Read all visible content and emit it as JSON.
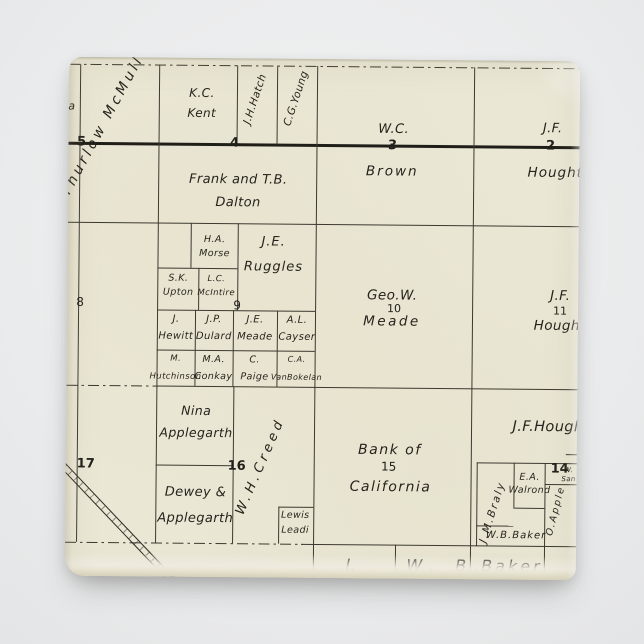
{
  "scene": {
    "type": "vintage plat map magnet product photo",
    "background_color": "#eaebec",
    "paper_color": "#eae7d5",
    "line_color": "#3c3930",
    "road_color": "#201e19",
    "text_color": "#26231c"
  },
  "map": {
    "section_numbers": {
      "s5": "5",
      "s4": "4",
      "s3": "3",
      "s2": "2",
      "s8": "8",
      "s9": "9",
      "s10": "10",
      "s11": "11",
      "s17": "17",
      "s16": "16",
      "s15": "15",
      "s14": "14"
    },
    "labels": {
      "edge_letter": "a",
      "mcmullen": "Thurlow McMullen",
      "kent": "K.C.\nKent",
      "hatch": "J.H.Hatch",
      "young": "C.G.Young",
      "brown_initials": "W.C.",
      "brown_surname": "Brown",
      "houghton2_initials": "J.F.",
      "houghton2_surname": "Hought",
      "dalton": "Frank and T.B.\nDalton",
      "morse": "H.A.\nMorse",
      "ruggles": "J.E.\nRuggles",
      "upton": "S.K.\nUpton",
      "mcintire": "L.C.\nMcIntire",
      "hewitt": "J.\nHewitt",
      "dulard": "J.P.\nDulard",
      "meade_small": "J.E.\nMeade",
      "cayser": "A.L.\nCayser",
      "hutchinson": "M.\nHutchinson",
      "conkay": "M.A.\nConkay",
      "paige": "C.\nPaige",
      "vanbokelan": "C.A.\nVanBokelan",
      "meade_initials": "Geo.W.",
      "meade_surname": "Meade",
      "houghton11_initials": "J.F.",
      "houghton11_surname": "Houghto",
      "applegarth_nina": "Nina\nApplegarth",
      "applegarth_dewey": "Dewey &\nApplegarth",
      "creed": "W.H.Creed",
      "leadi": "Lewis\nLeadi",
      "bank_line1": "Bank of",
      "bank_line2": "California",
      "houghton14": "J.F.Hough",
      "braly": "J.M.Braly",
      "walrond": "E.A.\nWalrond",
      "baker_wb": "W.B.Baker",
      "san_w": "W.\nSan",
      "applegarth_o": "O.Apple",
      "strip_j": "J.",
      "strip_wb": "W. B.",
      "strip_baker": "Baker"
    }
  }
}
